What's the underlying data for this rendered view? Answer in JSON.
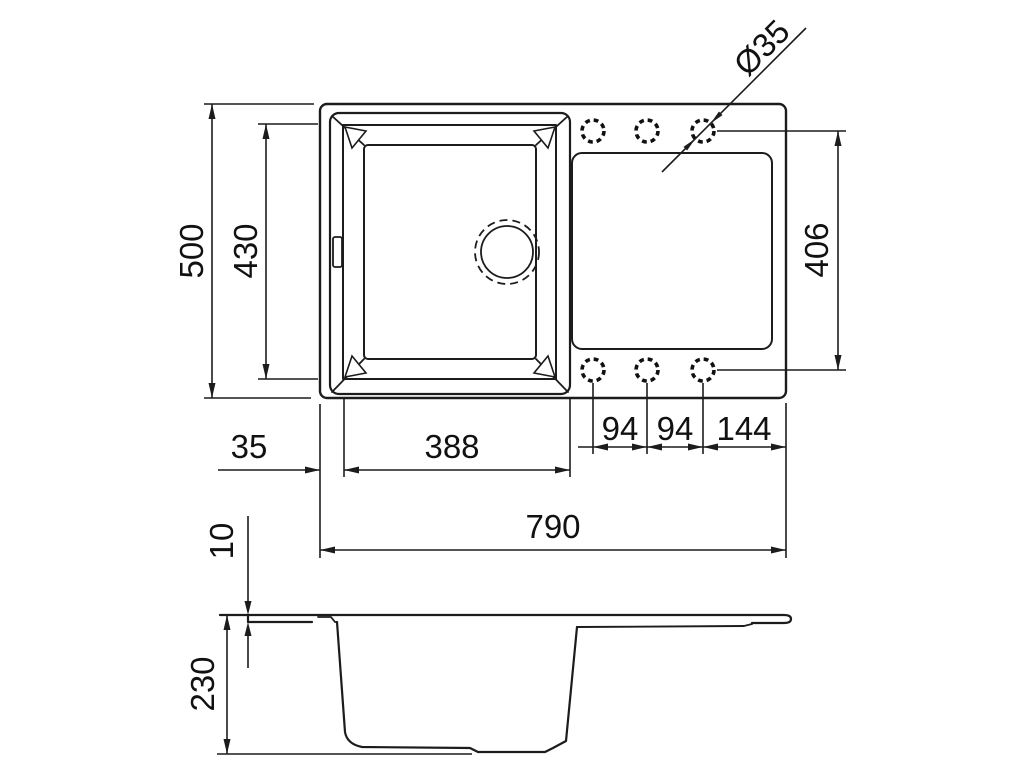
{
  "drawing": {
    "title": "sink-technical-drawing",
    "subject": "kitchen sink with single bowl and drainboard, plan view and side profile",
    "views": {
      "top": "plan-view",
      "bottom": "side-profile-view"
    },
    "colors": {
      "line": "#1c1c1c",
      "background": "#ffffff"
    },
    "dimensions": {
      "overall_width": "790",
      "overall_depth": "500",
      "bowl_opening_width": "388",
      "bowl_opening_depth": "430",
      "edge_to_bowl": "35",
      "hole_spacing_1": "94",
      "hole_spacing_2": "94",
      "hole_to_edge": "144",
      "hole_rows_span": "406",
      "rim_thickness": "10",
      "bowl_height": "230",
      "tap_hole_diameter": "Ø35"
    },
    "features": {
      "tap_hole_count": "6",
      "drain": "round waste outlet",
      "overflow": "overflow slot on left rim"
    }
  }
}
